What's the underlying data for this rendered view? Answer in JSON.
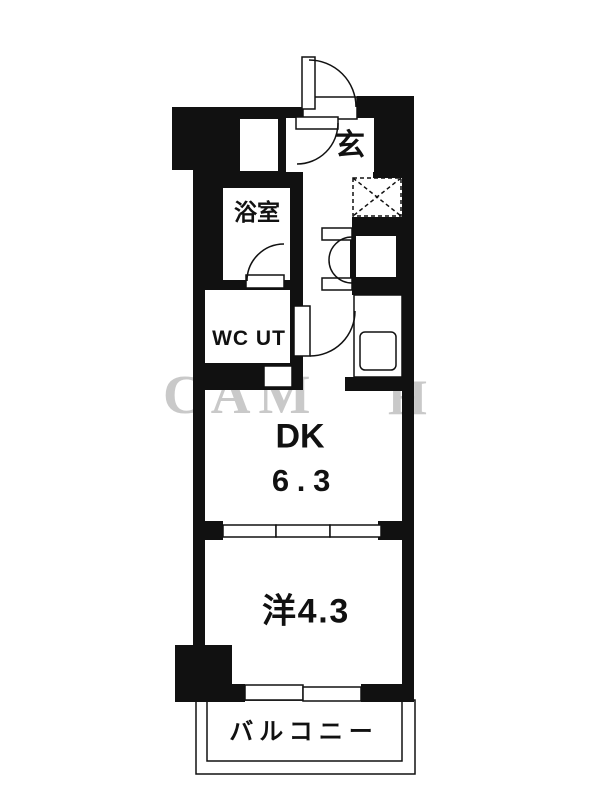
{
  "plan": {
    "type": "floor-plan",
    "rooms": {
      "genkan": {
        "label": "玄"
      },
      "bathroom": {
        "label": "浴室"
      },
      "wc_ut": {
        "label": "WC UT"
      },
      "dining_kitchen": {
        "label": "DK",
        "size": "6.3"
      },
      "western_room": {
        "label": "洋4.3"
      },
      "balcony": {
        "label": "バルコニー"
      }
    },
    "watermark": {
      "left": "CAM",
      "right": "H"
    },
    "colors": {
      "walls": "#111111",
      "background": "#ffffff",
      "watermark": "#c9c9c9"
    }
  }
}
